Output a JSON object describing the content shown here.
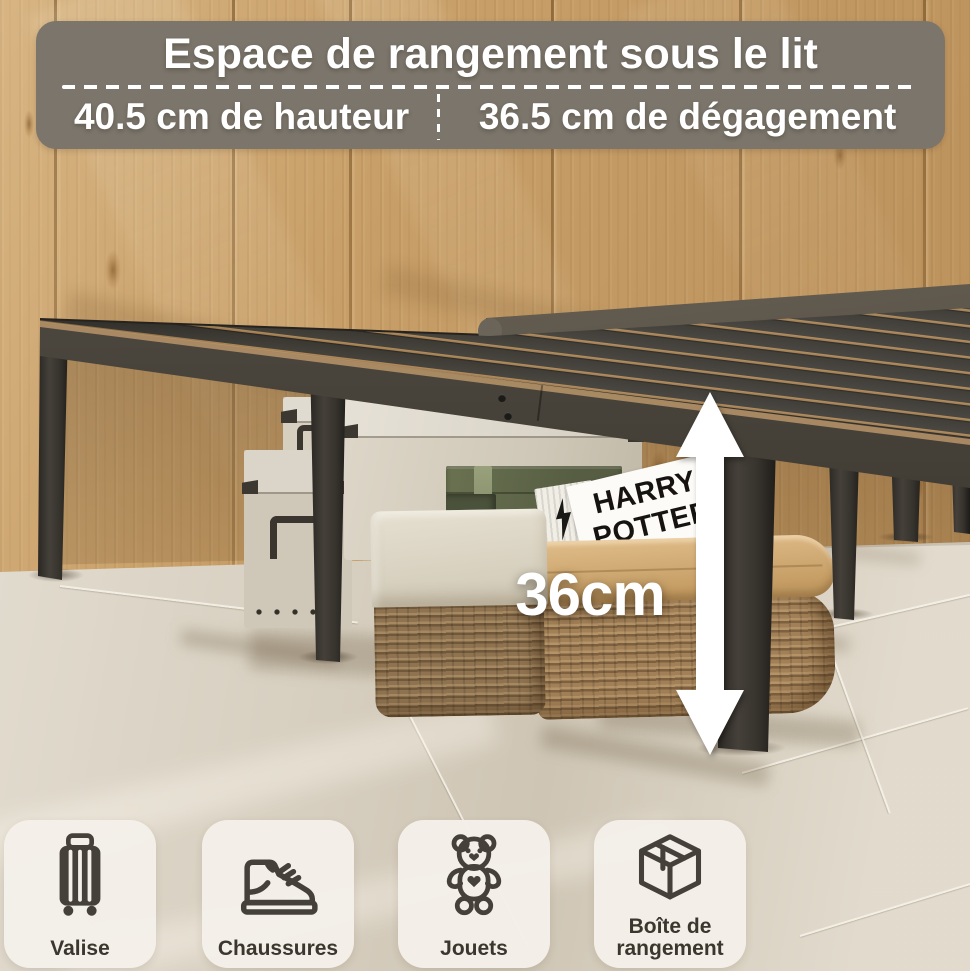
{
  "banner": {
    "title": "Espace de rangement sous le lit",
    "height_spec": "40.5 cm de hauteur",
    "clearance_spec": "36.5 cm de dégagement"
  },
  "measurement": {
    "under_bed_height": "36cm"
  },
  "book": {
    "title_line1": "HARRY",
    "title_line2": "POTTER"
  },
  "tiles": [
    {
      "label": "Valise",
      "icon": "suitcase-icon"
    },
    {
      "label": "Chaussures",
      "icon": "shoe-icon"
    },
    {
      "label": "Jouets",
      "icon": "teddy-bear-icon"
    },
    {
      "label": "Boîte de rangement",
      "icon": "storage-box-icon"
    }
  ],
  "colors": {
    "banner_bg": "#7b756b",
    "text_white": "#ffffff",
    "frame_dark": "#3d3933",
    "wood": "#c89f68",
    "floor": "#d8d0c1",
    "tile_bg": "#f4f0e9",
    "icon": "#45413a",
    "wicker": "#a28057",
    "leather_band": "#d3ae79",
    "green_box": "#5f6649"
  }
}
